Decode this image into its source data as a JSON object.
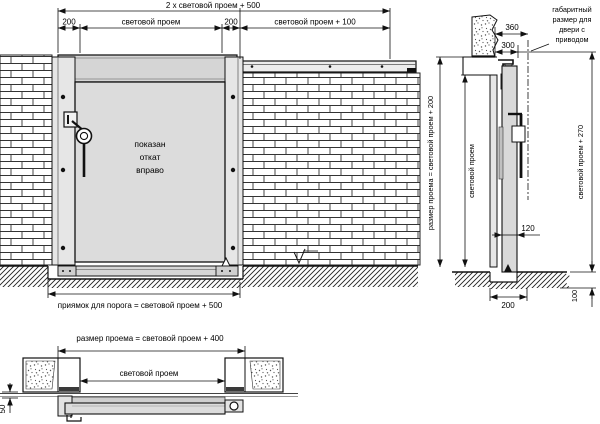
{
  "palette": {
    "line": "#1a1a1a",
    "panel_fill": "#dcdcdc",
    "hood_fill": "#d5d5d5",
    "background": "#ffffff"
  },
  "elevation": {
    "dim_total": "2 х световой проем + 500",
    "dim_left_200": "200",
    "dim_clear_opening": "световой проем",
    "dim_right_200": "200",
    "dim_opening_plus_100": "световой проем + 100",
    "door_note": [
      "показан",
      "откат",
      "вправо"
    ],
    "dim_pit": "приямок для порога = световой проем + 500"
  },
  "section": {
    "dim_360": "360",
    "dim_300": "300",
    "drive_note": [
      "габаритный",
      "размер для",
      "двери с",
      "приводом"
    ],
    "dim_opening_plus_200": "размер проема = световой проем + 200",
    "dim_clear_opening": "световой проем",
    "dim_opening_plus_270": "световой проем + 270",
    "dim_120": "120",
    "dim_200": "200",
    "dim_100": "100"
  },
  "plan": {
    "dim_opening_plus_400": "размер проема = световой проем + 400",
    "dim_clear_opening": "световой проем",
    "dim_50": "50"
  }
}
